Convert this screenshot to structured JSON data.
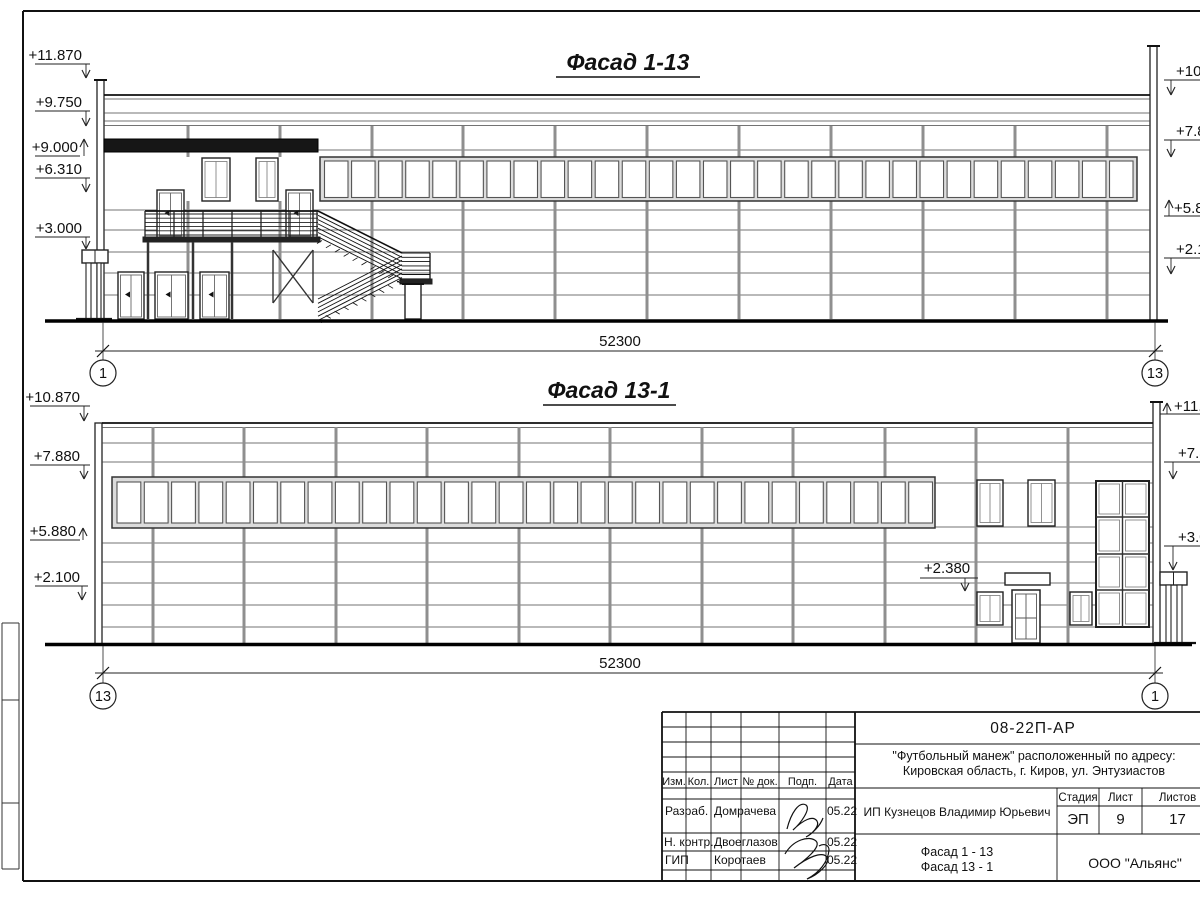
{
  "sheet": {
    "facade_top": {
      "title": "Фасад 1-13",
      "left_marks": [
        "+11.870",
        "+9.750",
        "+9.000",
        "+6.310",
        "+3.000"
      ],
      "right_marks": [
        "+10.8",
        "+7.8",
        "+5.8",
        "+2.1"
      ],
      "dimension": "52300",
      "axis_left": "1",
      "axis_right": "13"
    },
    "facade_bottom": {
      "title": "Фасад 13-1",
      "left_marks": [
        "+10.870",
        "+7.880",
        "+5.880",
        "+2.100"
      ],
      "right_marks": [
        "+11.8",
        "+7.8",
        "+3.0"
      ],
      "door_mark": "+2.380",
      "dimension": "52300",
      "axis_left": "13",
      "axis_right": "1"
    },
    "title_block": {
      "doc_number": "08-22П-АР",
      "project_line1": "\"Футбольный манеж\" расположенный по адресу:",
      "project_line2": "Кировская область, г. Киров, ул. Энтузиастов",
      "columns": [
        "Изм.",
        "Кол.",
        "Лист",
        "№ док.",
        "Подп.",
        "Дата"
      ],
      "signers": [
        {
          "role": "Разраб.",
          "name": "Домрачева",
          "date": "05.22"
        },
        {
          "role": "Н. контр.",
          "name": "Двоеглазов",
          "date": "05.22"
        },
        {
          "role": "ГИП",
          "name": "Коротаев",
          "date": "05.22"
        }
      ],
      "client": "ИП Кузнецов Владимир Юрьевич",
      "stage_label": "Стадия",
      "sheet_label": "Лист",
      "total_label": "Листов",
      "stage": "ЭП",
      "sheet_number": "9",
      "total_sheets": "17",
      "drawing_title_line1": "Фасад 1 - 13",
      "drawing_title_line2": "Фасад 13 - 1",
      "company": "ООО \"Альянс\""
    }
  }
}
